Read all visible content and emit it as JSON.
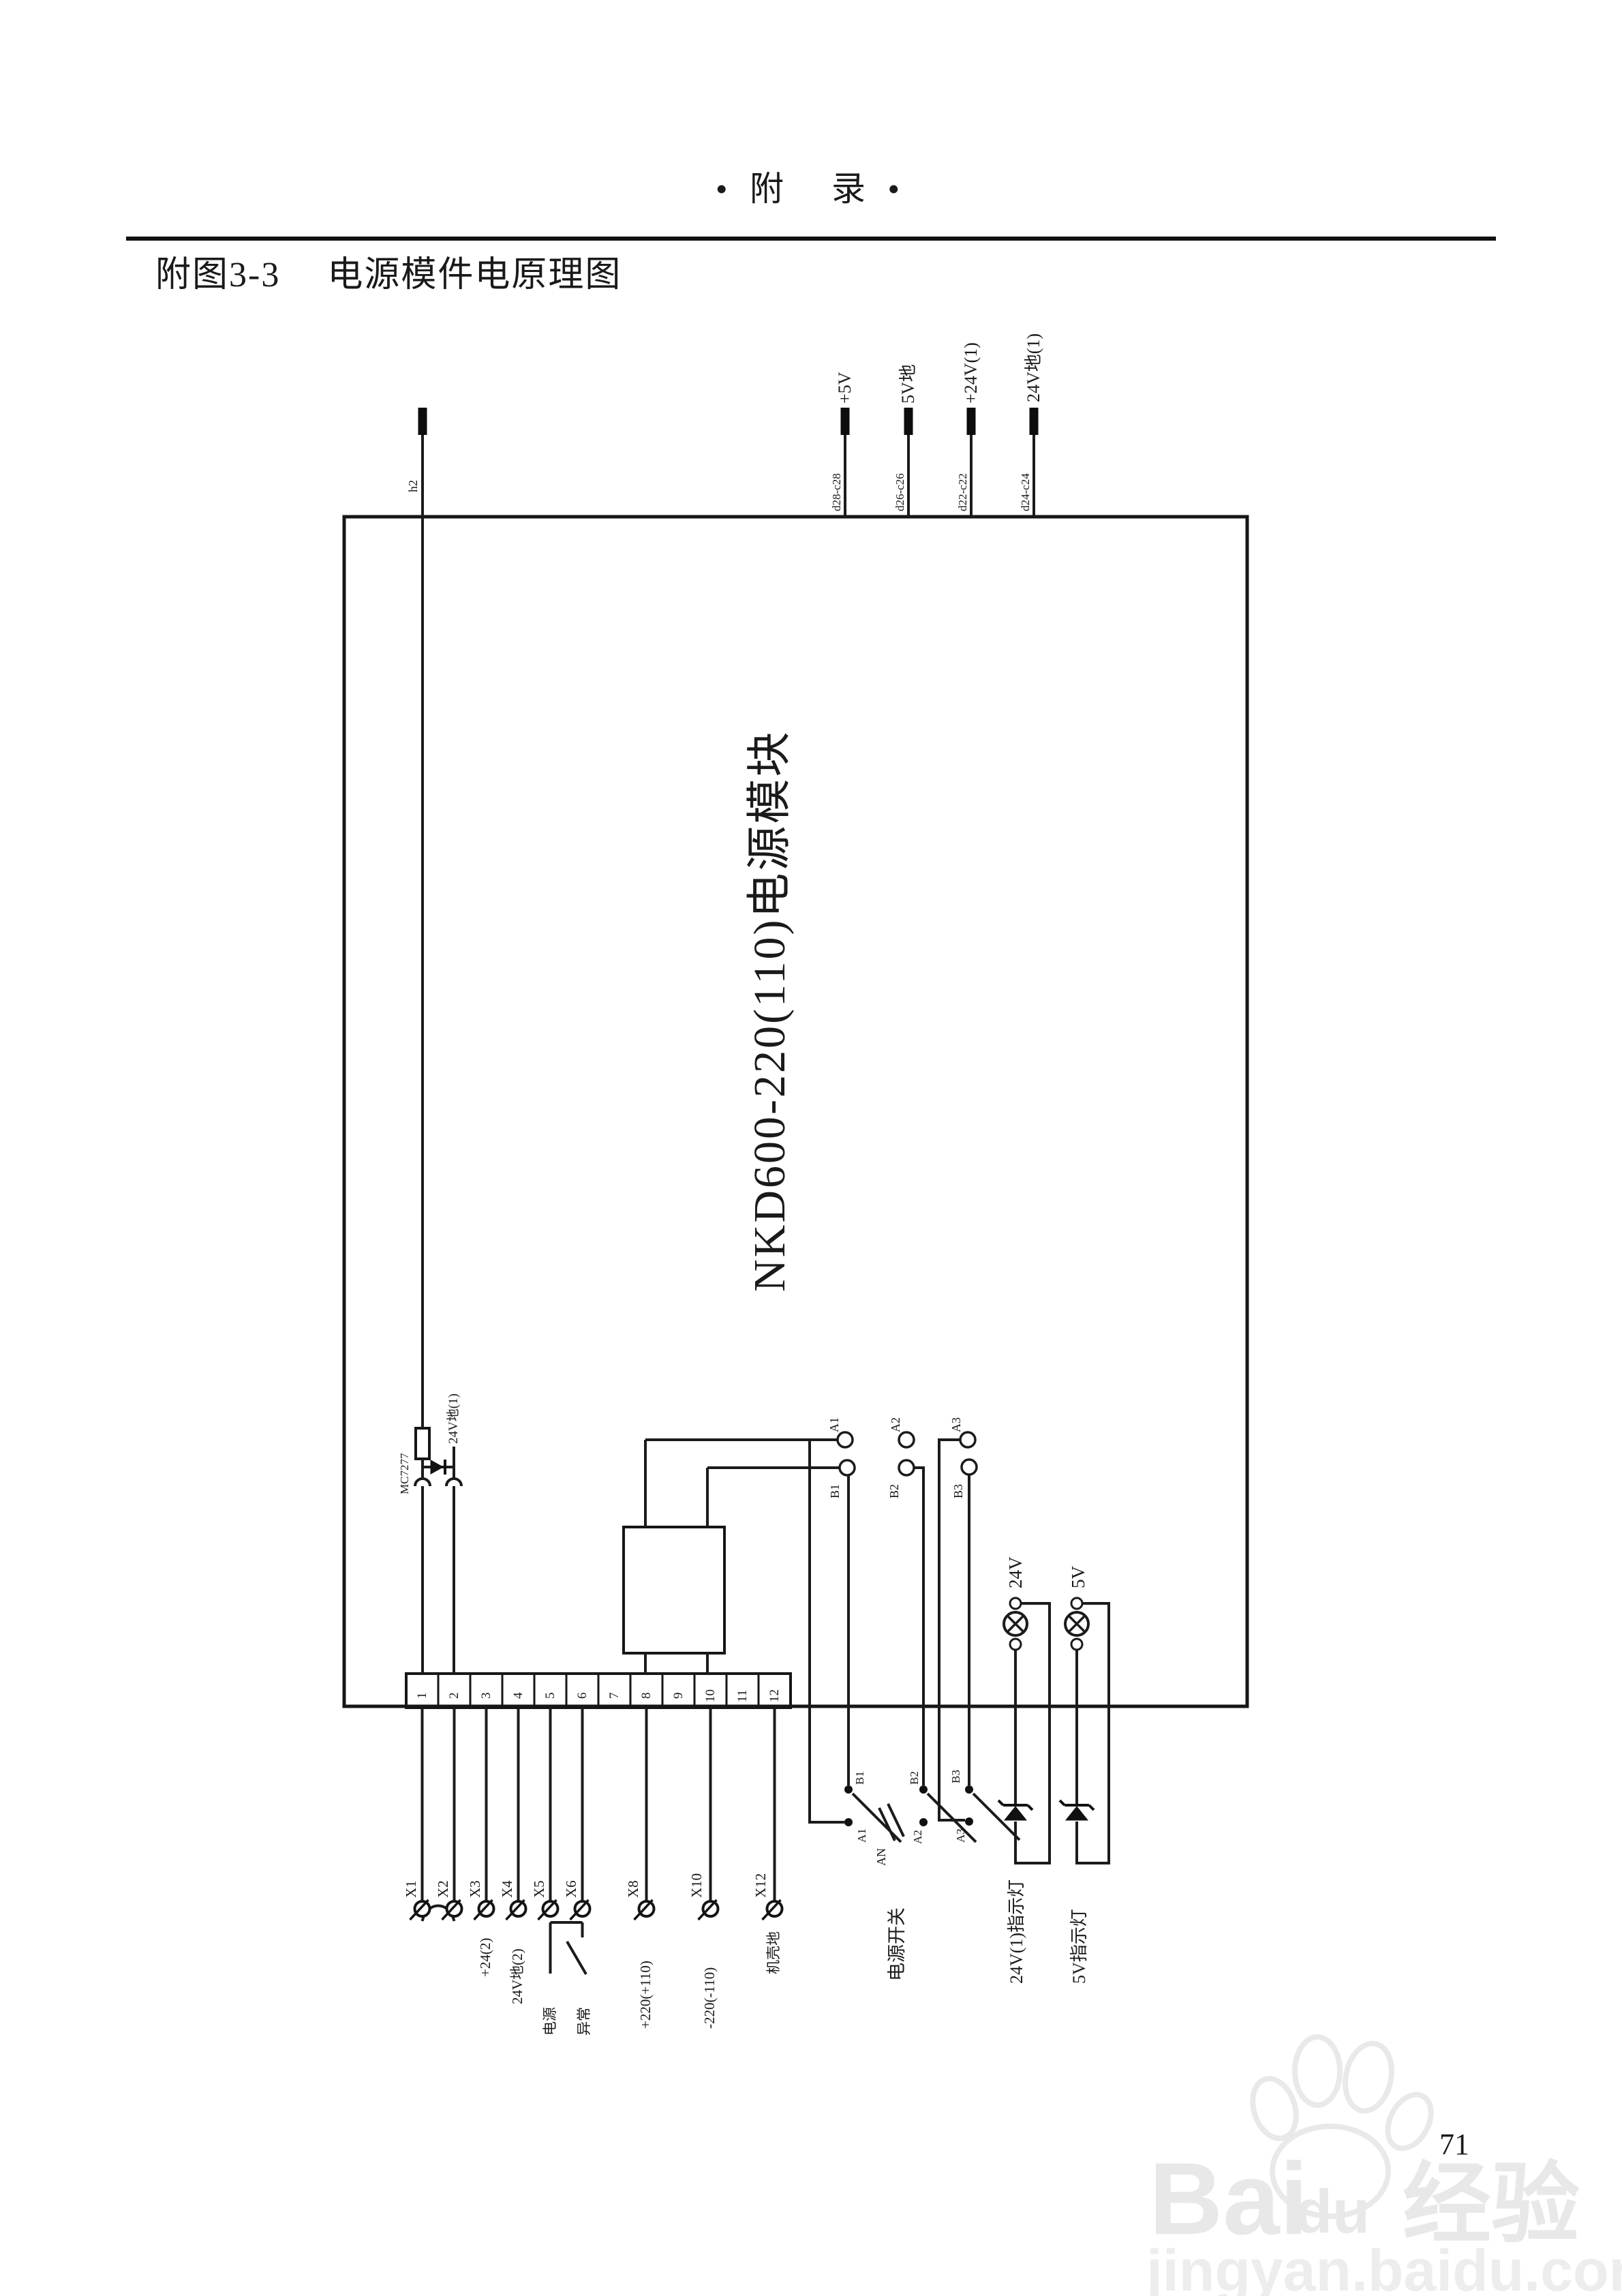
{
  "page": {
    "header": "• 附　录 •",
    "title": "附图3-3　 电源模件电原理图",
    "page_number": "71"
  },
  "watermark": {
    "brand_latin": "Bai",
    "brand_paw": "du",
    "brand_cjk": "经验",
    "url": "jingyan.baidu.com"
  },
  "module": {
    "name": "NKD600-220(110)电源模块"
  },
  "top_pins": [
    {
      "label": "+5V",
      "pin": "d28-c28"
    },
    {
      "label": "5V地",
      "pin": "d26-c26"
    },
    {
      "label": "+24V(1)",
      "pin": "d22-c22"
    },
    {
      "label": "24V地(1)",
      "pin": "d24-c24"
    }
  ],
  "left_pin": "h2",
  "regulator": {
    "part": "MC7277",
    "net": "24V地(1)"
  },
  "terminals": [
    "1",
    "2",
    "3",
    "4",
    "5",
    "6",
    "7",
    "8",
    "9",
    "10",
    "11",
    "12"
  ],
  "x_terminals": [
    "X1",
    "X2",
    "X3",
    "X4",
    "X5",
    "X6",
    "X8",
    "X10",
    "X12"
  ],
  "io_labels": {
    "x3": "+24(2)",
    "x4": "24V地(2)",
    "fault_a": "电源",
    "fault_b": "异常",
    "x8": "+220(+110)",
    "x10": "-220(-110)",
    "x12": "机壳地"
  },
  "sockets": {
    "a": [
      "A1",
      "A2",
      "A3"
    ],
    "b": [
      "B1",
      "B2",
      "B3"
    ]
  },
  "power_switch": {
    "label": "电源开关",
    "button": "AN",
    "b_contacts": [
      "B1",
      "B2",
      "B3"
    ],
    "a_contacts": [
      "A1",
      "A2",
      "A3"
    ]
  },
  "lamps": [
    {
      "label": "24V",
      "caption": "24V(1)指示灯"
    },
    {
      "label": "5V",
      "caption": "5V指示灯"
    }
  ]
}
